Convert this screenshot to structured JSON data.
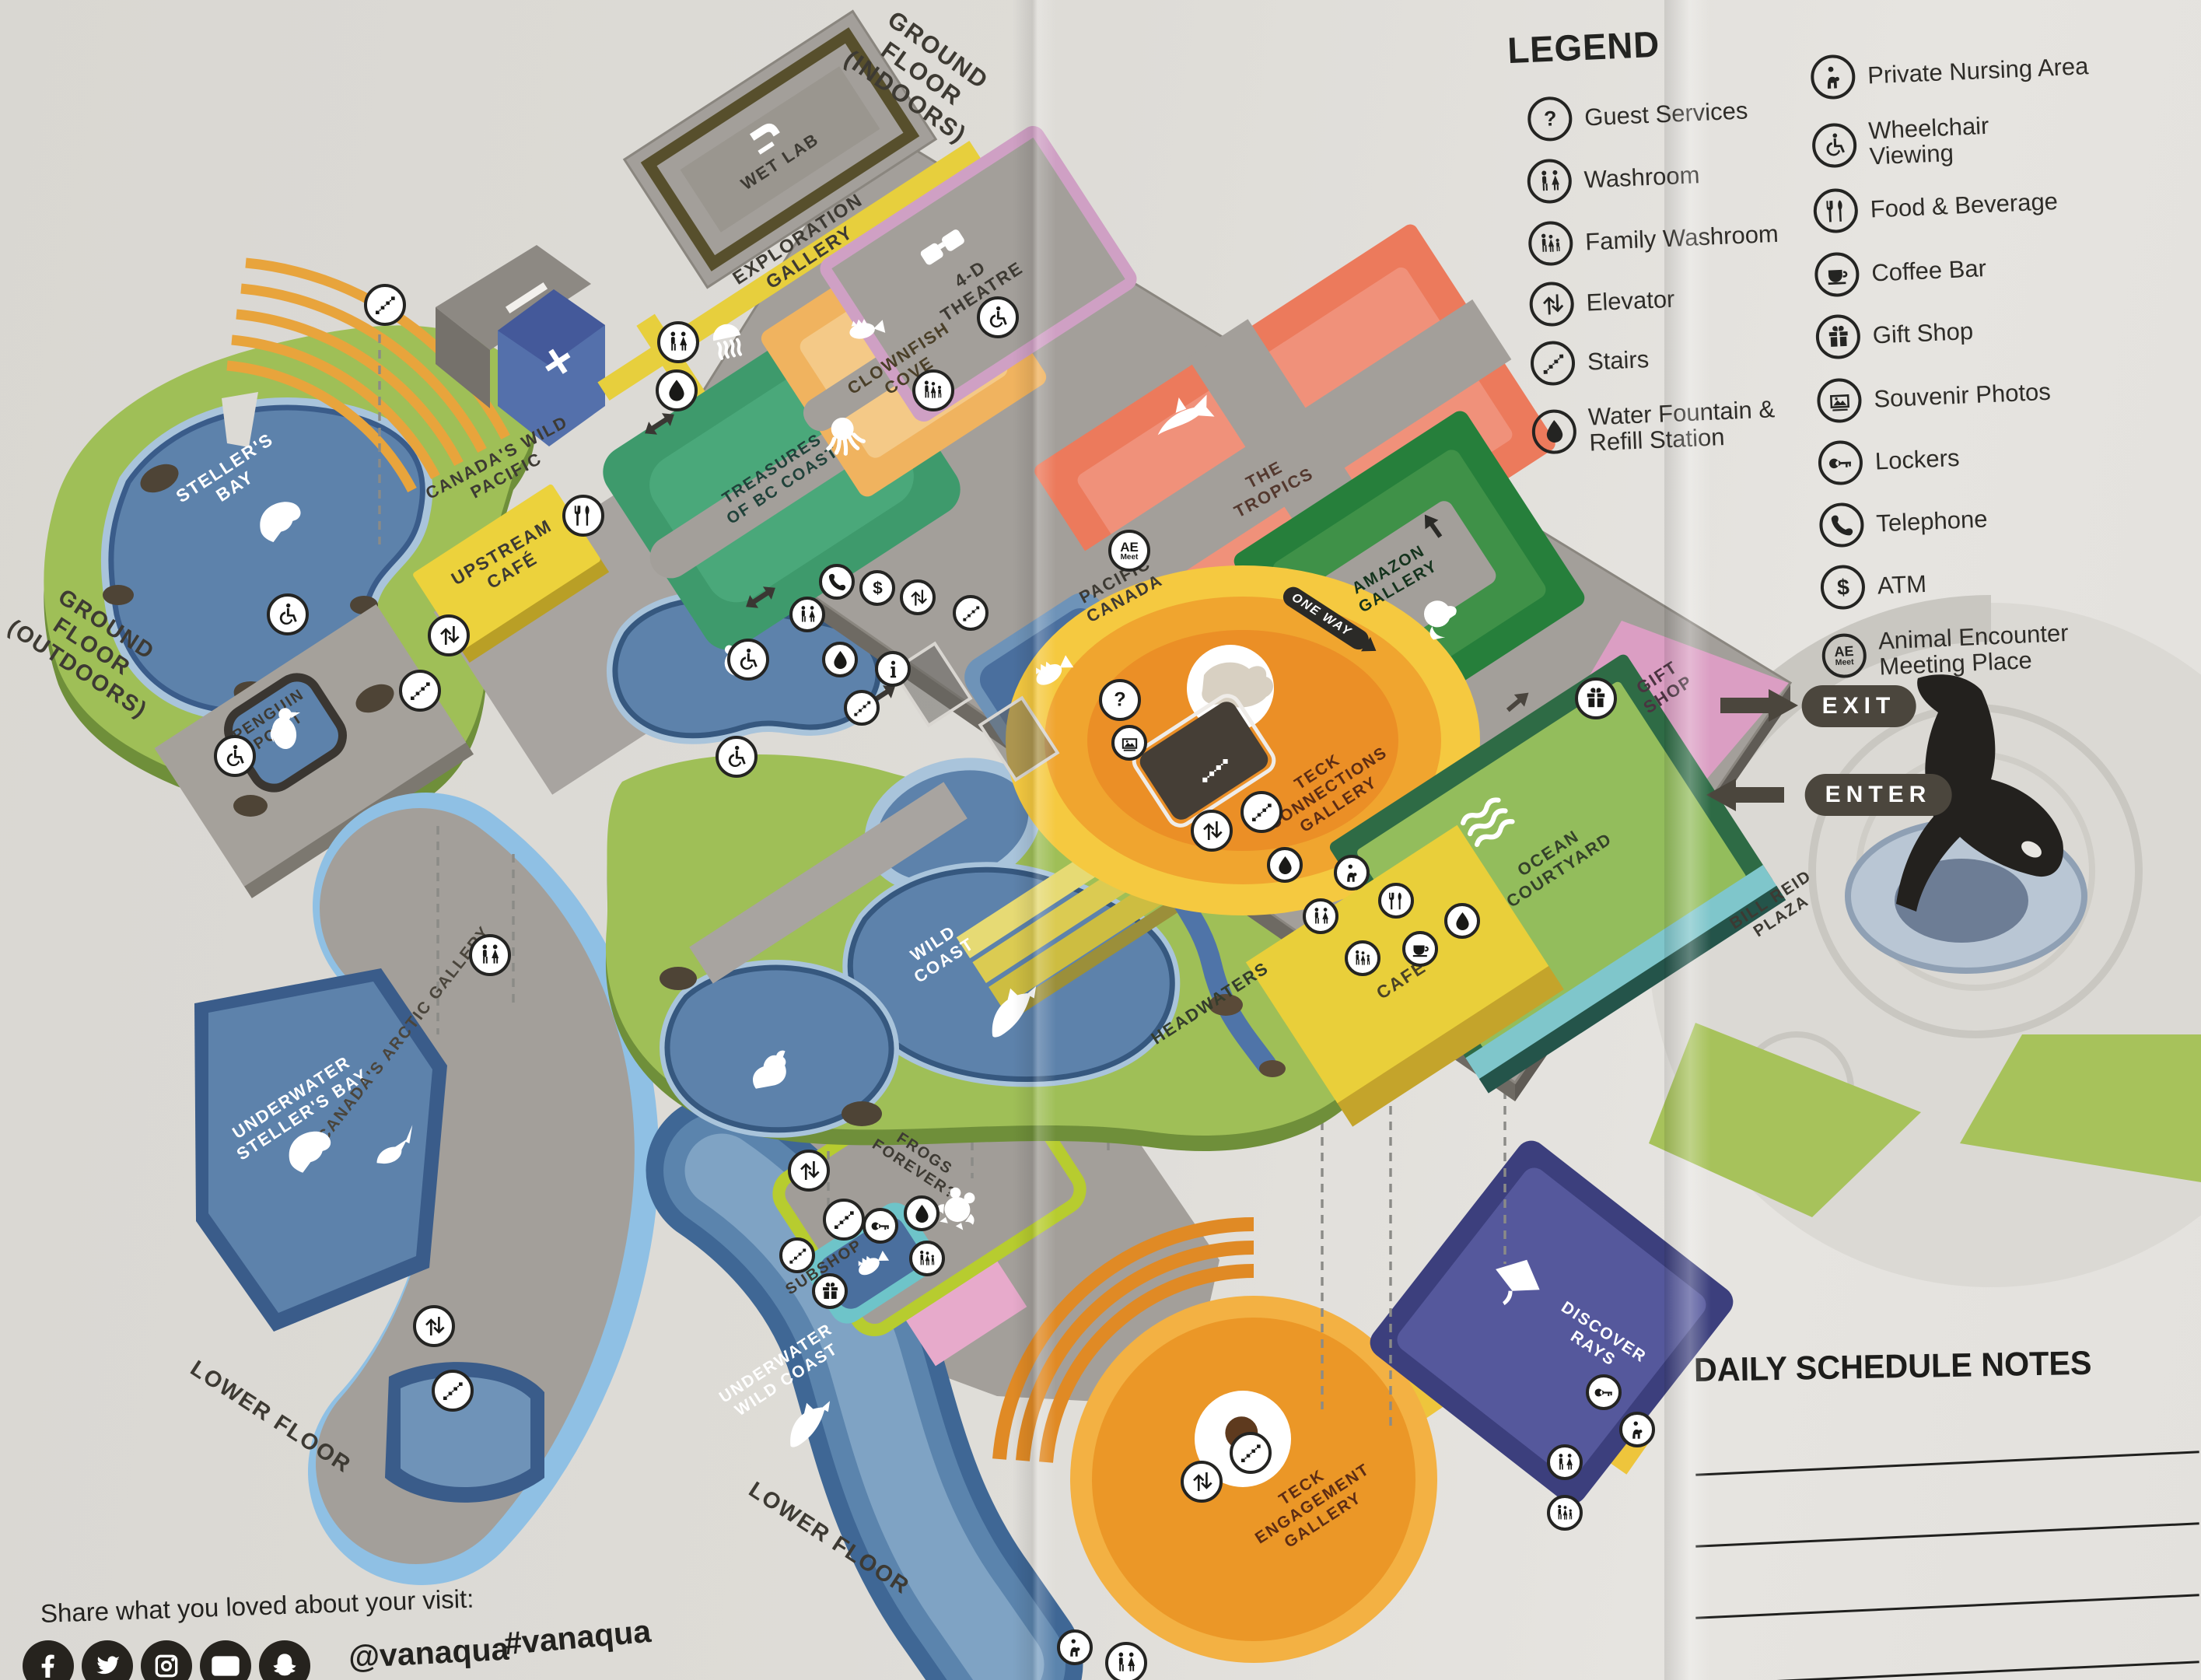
{
  "legend": {
    "title": "LEGEND",
    "column1": [
      {
        "icon": "guest-services-icon",
        "label": "Guest Services"
      },
      {
        "icon": "washroom-icon",
        "label": "Washroom"
      },
      {
        "icon": "family-washroom-icon",
        "label": "Family Washroom"
      },
      {
        "icon": "elevator-icon",
        "label": "Elevator"
      },
      {
        "icon": "stairs-icon",
        "label": "Stairs"
      },
      {
        "icon": "water-fountain-icon",
        "label": "Water Fountain & Refill Station"
      }
    ],
    "column2": [
      {
        "icon": "private-nursing-icon",
        "label": "Private Nursing Area"
      },
      {
        "icon": "wheelchair-viewing-icon",
        "label": "Wheelchair Viewing"
      },
      {
        "icon": "food-beverage-icon",
        "label": "Food & Beverage"
      },
      {
        "icon": "coffee-bar-icon",
        "label": "Coffee Bar"
      },
      {
        "icon": "gift-shop-icon",
        "label": "Gift Shop"
      },
      {
        "icon": "souvenir-photos-icon",
        "label": "Souvenir Photos"
      },
      {
        "icon": "lockers-icon",
        "label": "Lockers"
      },
      {
        "icon": "telephone-icon",
        "label": "Telephone"
      },
      {
        "icon": "atm-icon",
        "label": "ATM"
      },
      {
        "icon": "animal-encounter-icon",
        "label": "Animal Encounter Meeting Place"
      }
    ]
  },
  "floors": {
    "ground_indoors": "GROUND FLOOR (INDOORS)",
    "ground_outdoors": "GROUND FLOOR (OUTDOORS)",
    "lower_left": "LOWER FLOOR",
    "lower_bottom": "LOWER FLOOR"
  },
  "areas": {
    "wet_lab": "WET LAB",
    "exploration_gallery": "EXPLORATION GALLERY",
    "theatre_4d": "4-D THEATRE",
    "clownfish_cove": "CLOWNFISH COVE",
    "treasures_bc_coast": "TREASURES OF BC COAST",
    "the_tropics": "THE TROPICS",
    "pacific_canada": "PACIFIC CANADA",
    "amazon_gallery": "AMAZON GALLERY",
    "teck_connections_gallery": "TECK CONNECTIONS GALLERY",
    "gift_shop": "GIFT SHOP",
    "ocean_courtyard": "OCEAN COURTYARD",
    "cafe": "CAFÉ",
    "upstream_cafe": "UPSTREAM CAFÉ",
    "canadas_wild_pacific": "CANADA'S WILD PACIFIC",
    "stellers_bay": "STELLER'S BAY",
    "penguin_point": "PENGUIN POINT",
    "wild_coast": "WILD COAST",
    "headwaters": "HEADWATERS",
    "bill_reid_plaza": "BILL REID PLAZA",
    "underwater_stellers_bay": "UNDERWATER STELLER'S BAY",
    "canadas_arctic_gallery": "CANADA'S ARCTIC GALLERY",
    "frogs_forever": "FROGS FOREVER?",
    "subshop": "SUBSHOP",
    "underwater_wild_coast": "UNDERWATER WILD COAST",
    "teck_engagement_gallery": "TECK ENGAGEMENT GALLERY",
    "discover_rays": "DISCOVER RAYS"
  },
  "wayfinding": {
    "exit": "EXIT",
    "enter": "ENTER",
    "one_way": "ONE WAY",
    "ae_badge_top": "AE",
    "ae_badge_bottom": "Meet"
  },
  "notes": {
    "title": "DAILY SCHEDULE NOTES"
  },
  "social": {
    "prompt": "Share what you loved about your visit:",
    "handle": "@vanaqua",
    "hashtag": "#vanaqua",
    "icons": [
      "facebook-icon",
      "twitter-icon",
      "instagram-icon",
      "youtube-icon",
      "snapchat-icon"
    ]
  },
  "map_amenity_icons": [
    "washroom-icon",
    "family-washroom-icon",
    "wheelchair-icon",
    "stairs-icon",
    "elevator-icon",
    "water-fountain-icon",
    "guest-services-icon",
    "info-icon",
    "telephone-icon",
    "atm-icon",
    "lockers-icon",
    "gift-shop-icon",
    "souvenir-photos-icon",
    "coffee-bar-icon",
    "food-beverage-icon",
    "private-nursing-icon",
    "animal-encounter-icon"
  ],
  "colors": {
    "paper": "#dedcd7",
    "floor_gray": "#a39f9a",
    "outdoor_green": "#9fbf57",
    "pool_blue": "#5d82ab",
    "cafe_yellow": "#ecd23c",
    "tropics_red": "#ec7a5c",
    "cove_orange": "#f0b35f",
    "gallery_green": "#3e9a6c",
    "amazon_green": "#267f3b",
    "gift_pink": "#db9ec3",
    "theatre_pink": "#cfa0c4",
    "teck_orange": "#eb8f26",
    "rays_purple": "#55589c",
    "frogs_lime": "#b7cc2f",
    "pill_dark": "#4b463d"
  }
}
